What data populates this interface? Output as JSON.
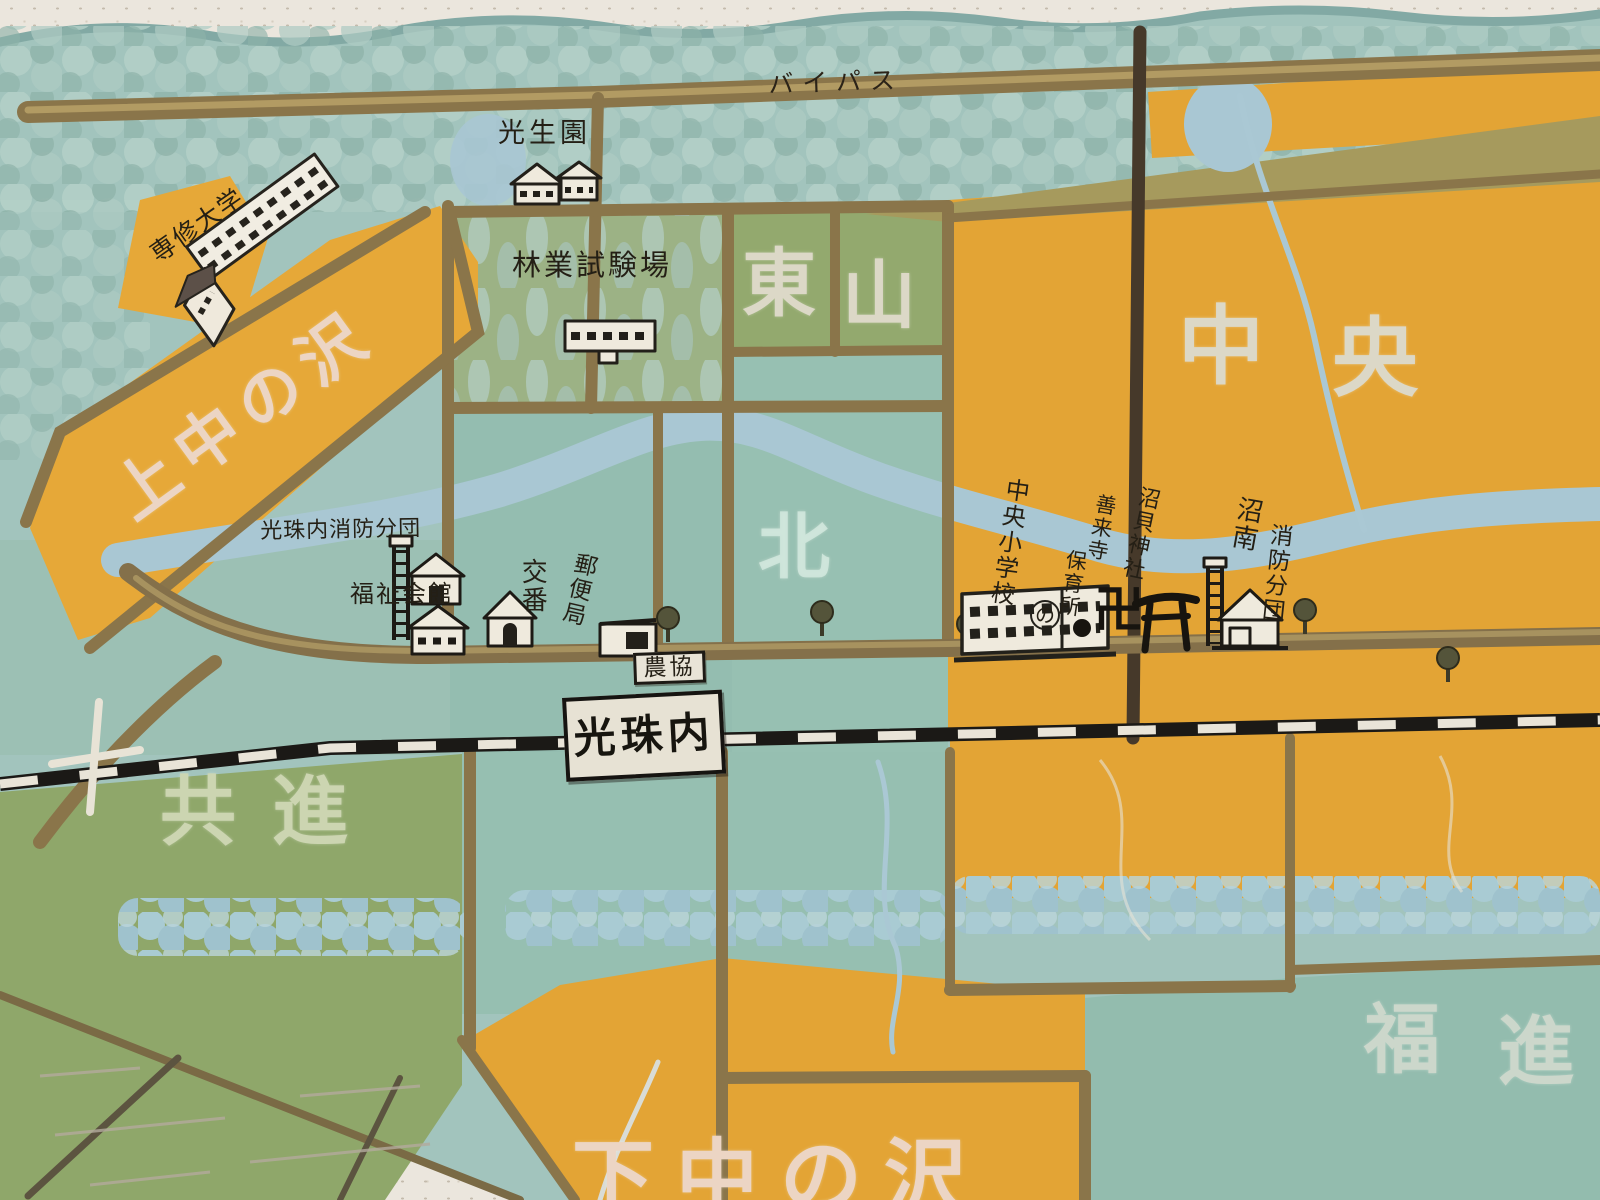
{
  "map": {
    "kind": "hand-painted town guide map",
    "road_labels": {
      "bypass": "バイパス"
    },
    "railway": {
      "station_sign": "光珠内"
    },
    "districts": {
      "kaminakanosawa": "上中の沢",
      "higashiyama": [
        "東",
        "山"
      ],
      "chuo": [
        "中",
        "央"
      ],
      "kita": "北",
      "kyoshin": "共進",
      "fukushin": [
        "福",
        "進"
      ],
      "shimonakanosawa": "下中の沢"
    },
    "facilities": {
      "senshu_university": "専修大学",
      "koseien": "光生園",
      "forestry_experiment_station": "林業試験場",
      "koshunai_fire_brigade": "光珠内消防分団",
      "welfare_hall": "福祉会館",
      "police_box": "交番",
      "post_office": "郵便局",
      "agricultural_coop": "農協",
      "chuo_elementary_school": "中央小学校",
      "school_mark": "の",
      "zenraiji_temple": "善来寺",
      "nursery_school": "保育所",
      "temple_manji_mark": "卍",
      "numakai_shrine": "沼貝神社",
      "shonan": "沼南",
      "fire_brigade": "消防分団"
    },
    "colors": {
      "board_white": "#ebe6dd",
      "forest_teal": "#a2c4bd",
      "field_olive_green": "#93a96e",
      "field_teal": "#97c0b2",
      "field_orange": "#e3a435",
      "river_blue": "#a9c7d3",
      "road_brown": "#8a754a",
      "rail_black": "#1b1916",
      "white_text": "#dcd8c7",
      "pink_text": "#ecd5c4"
    }
  }
}
